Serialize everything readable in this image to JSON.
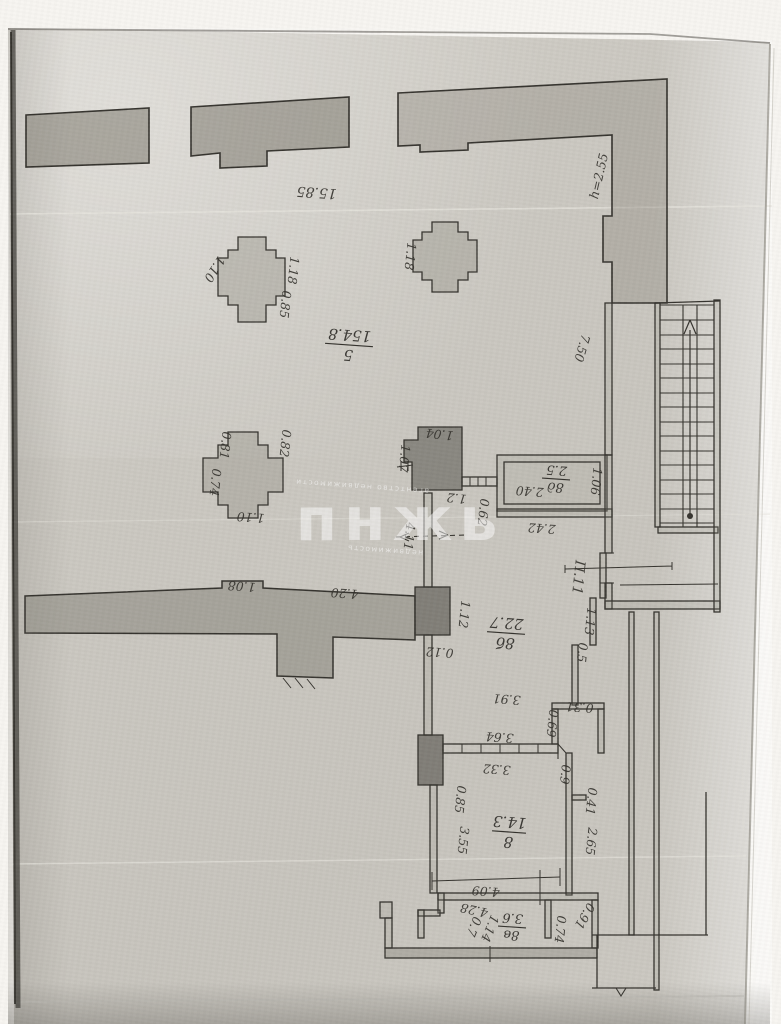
{
  "watermark": {
    "brand": "пнжь",
    "caption_top": "агентство недвижимости",
    "caption_bottom": "недвижимость"
  },
  "rooms": [
    {
      "number": "5",
      "area": "154.8"
    },
    {
      "number": "8б",
      "area": "22.7"
    },
    {
      "number": "8",
      "area": "14.3"
    },
    {
      "number": "8в",
      "area": "3.6"
    },
    {
      "number": "8д",
      "area": "2.5"
    }
  ],
  "dims": [
    "15.85",
    "h=2.55",
    "1.10",
    "1.18",
    "0.85",
    "1.18",
    "0.81",
    "0.82",
    "0.74",
    "1.10",
    "1.04",
    "1.07",
    "1.2",
    "0.62",
    "1.06",
    "2.40",
    "2.42",
    "7.50",
    "П.11",
    "1.13",
    "0.5",
    "1.12",
    "0.12",
    "4.11",
    "1.08",
    "4.20",
    "0.85",
    "3.64",
    "3.32",
    "0.9",
    "0.69",
    "0.31",
    "3.91",
    "0.41",
    "3.55",
    "2.65",
    "4.09",
    "4.28",
    "0.7",
    "1.14",
    "0.74",
    "0.91"
  ]
}
